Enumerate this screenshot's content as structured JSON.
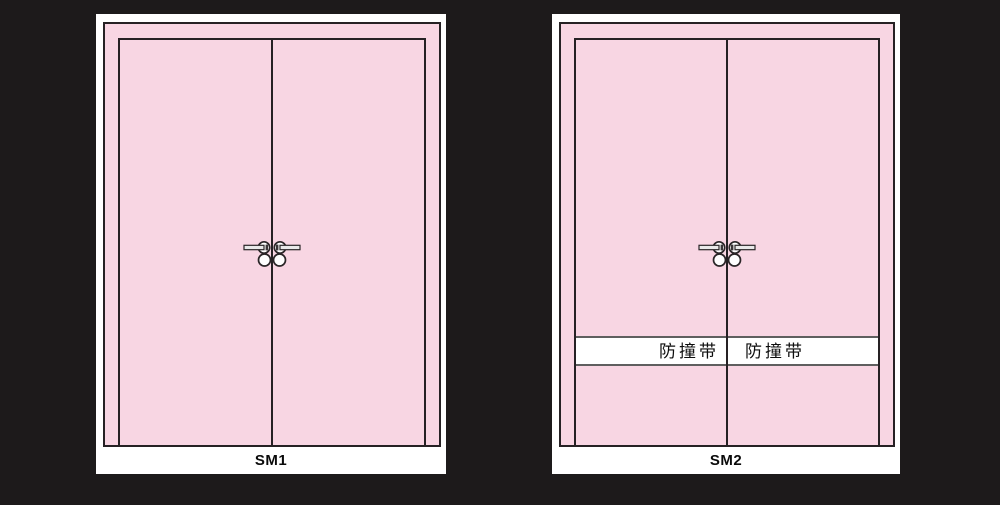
{
  "page": {
    "background_color": "#1d1a1b",
    "card_background": "#ffffff",
    "door_fill_color": "#f8d6e3",
    "line_color": "#262124",
    "bumper_strip_background": "#ffffff",
    "bumper_strip_border_color": "#5f5f5f"
  },
  "doors": [
    {
      "label": "SM1",
      "type": "double-leaf door elevation",
      "has_bumper_strip": false
    },
    {
      "label": "SM2",
      "type": "double-leaf door elevation",
      "has_bumper_strip": true,
      "bumper_strip": {
        "left_label": "防撞带",
        "right_label": "防撞带"
      }
    }
  ]
}
